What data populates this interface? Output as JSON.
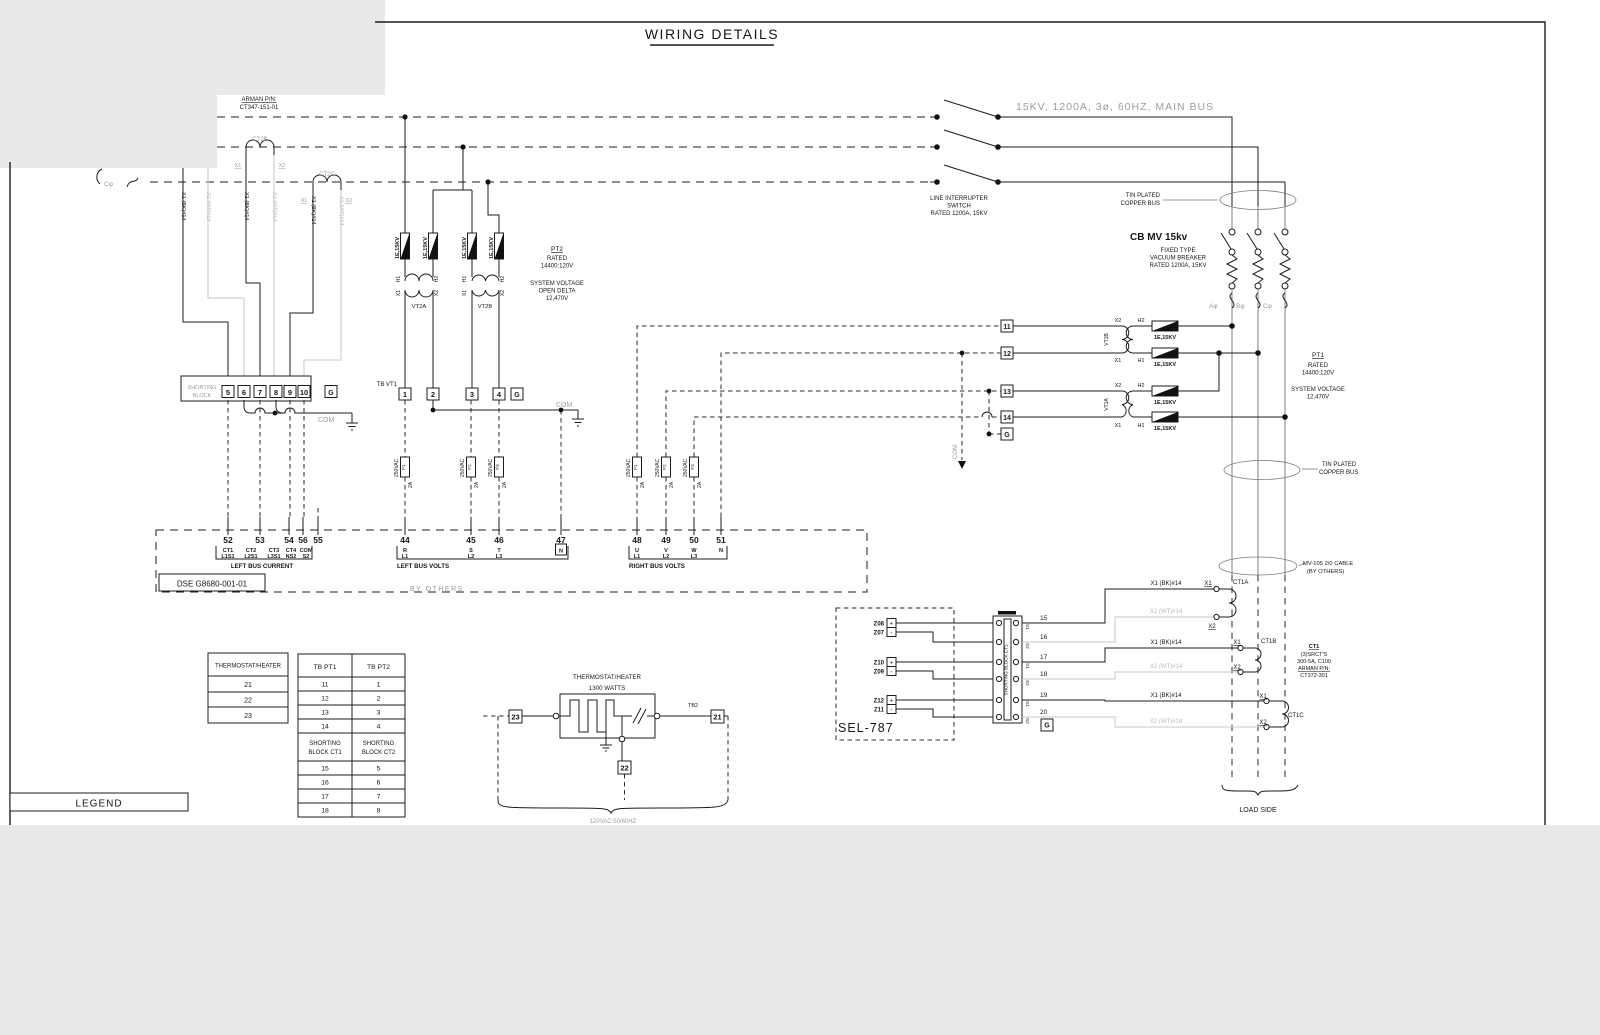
{
  "title": "WIRING DETAILS",
  "legend": "LEGEND",
  "w": {
    "x1": "X1",
    "x2": "X2",
    "h1": "H1",
    "h2": "H2",
    "bk": "X1 (BK)#14",
    "wt": "X2 (WT)#14",
    "fuse": "1E,15KV",
    "g": "G",
    "vac": "250VAC",
    "amp": "2A",
    "f1": "F1",
    "f2": "F2",
    "f3": "F3",
    "com": "COM",
    "n": "N"
  },
  "tl": {
    "arman1": "ARMAN P/N:",
    "arman2": "CT347-151-01",
    "ct2b": "CT2B",
    "ct2c": "CT2C",
    "cphi": "Cφ"
  },
  "sb": {
    "l1": "SHORTING",
    "l2": "BLOCK",
    "terms": [
      "5",
      "6",
      "7",
      "8",
      "9",
      "10"
    ]
  },
  "pt2": {
    "name": "PT2",
    "rated": "RATED",
    "ratio": "14400:120V",
    "sys1": "SYSTEM VOLTAGE",
    "sys2": "OPEN DELTA",
    "sys3": "12,470V",
    "vt2a": "VT2A",
    "vt2b": "VT2B",
    "tb": "TB VT1",
    "terms": [
      "1",
      "2",
      "3",
      "4"
    ]
  },
  "row": {
    "lbc": {
      "nums": [
        "52",
        "53",
        "54",
        "56",
        "55"
      ],
      "r1": [
        "CT1",
        "CT2",
        "CT3",
        "CT4",
        "COM"
      ],
      "r2": [
        "L1S1",
        "L2S1",
        "L3S1",
        "NS2",
        "S2"
      ],
      "title": "LEFT BUS CURRENT"
    },
    "lbv": {
      "nums": [
        "44",
        "45",
        "46",
        "47"
      ],
      "r1": [
        "R",
        "S",
        "T"
      ],
      "r2": [
        "L1",
        "L2",
        "L3"
      ],
      "title": "LEFT BUS VOLTS"
    },
    "rbv": {
      "nums": [
        "48",
        "49",
        "50",
        "51"
      ],
      "r1": [
        "U",
        "V",
        "W"
      ],
      "r2": [
        "L1",
        "L2",
        "L3"
      ],
      "title": "RIGHT BUS VOLTS"
    }
  },
  "dse": "DSE  G8680-001-01",
  "by": "BY OTHERS",
  "bus": {
    "main": "15KV, 1200A, 3ø, 60HZ, MAIN BUS",
    "lis1": "LINE INTERRUPTER",
    "lis2": "SWITCH",
    "lis3": "RATED 1200A, 15KV",
    "tin1": "TIN PLATED",
    "tin2": "COPPER BUS",
    "aphi": "Aφ",
    "bphi": "Bφ",
    "cphi": "Cφ"
  },
  "cb": {
    "t": "CB  MV  15kv",
    "l1": "FIXED TYPE",
    "l2": "VACUUM BREAKER",
    "l3": "RATED 1200A, 15KV",
    "blue": "#2496cc"
  },
  "pt1": {
    "name": "PT1",
    "rated": "RATED",
    "ratio": "14400:120V",
    "sys1": "SYSTEM VOLTAGE",
    "sys2": "12,470V",
    "vt1b": "VT1B",
    "vt1a": "VT1A",
    "terms": [
      "11",
      "12",
      "13",
      "14"
    ]
  },
  "mv": {
    "l1": "MV-105 2/0  CABLE",
    "l2": "(BY OTHERS)"
  },
  "ct1": {
    "name": "CT1",
    "l1": "(3)SRCT'S",
    "l2": "300-5A, C100",
    "l3": "ARMAN P/N:",
    "l4": "CT372-301",
    "a": "CT1A",
    "b": "CT1B",
    "c": "CT1C"
  },
  "sel": {
    "name": "SEL-787",
    "z": [
      "Z08",
      "Z07",
      "Z10",
      "Z09",
      "Z12",
      "Z11"
    ],
    "plus": "+",
    "minus": "-",
    "nums": [
      "15",
      "16",
      "17",
      "18",
      "19",
      "20"
    ],
    "s1": "S1",
    "s2": "S2",
    "strip": "SHORTING BLOCK CT1"
  },
  "load": "LOAD SIDE",
  "th": {
    "name": "THERMOSTAT/HEATER",
    "watts": "1300 WATTS",
    "tb2": "TB2",
    "t21": "21",
    "t22": "22",
    "t23": "23",
    "vac": "120VAC 50/60HZ"
  },
  "tt": {
    "h": "THERMOSTAT/HEATER",
    "rows": [
      "21",
      "22",
      "23"
    ]
  },
  "tb": {
    "h1": "TB PT1",
    "h2": "TB PT2",
    "rows": [
      [
        "11",
        "1"
      ],
      [
        "12",
        "2"
      ],
      [
        "13",
        "3"
      ],
      [
        "14",
        "4"
      ]
    ],
    "sb1": [
      "SHORTING",
      "BLOCK CT1"
    ],
    "sb2": [
      "SHORTING",
      "BLOCK CT2"
    ],
    "rows2": [
      [
        "15",
        "5"
      ],
      [
        "16",
        "6"
      ],
      [
        "17",
        "7"
      ],
      [
        "18",
        "8"
      ]
    ]
  }
}
